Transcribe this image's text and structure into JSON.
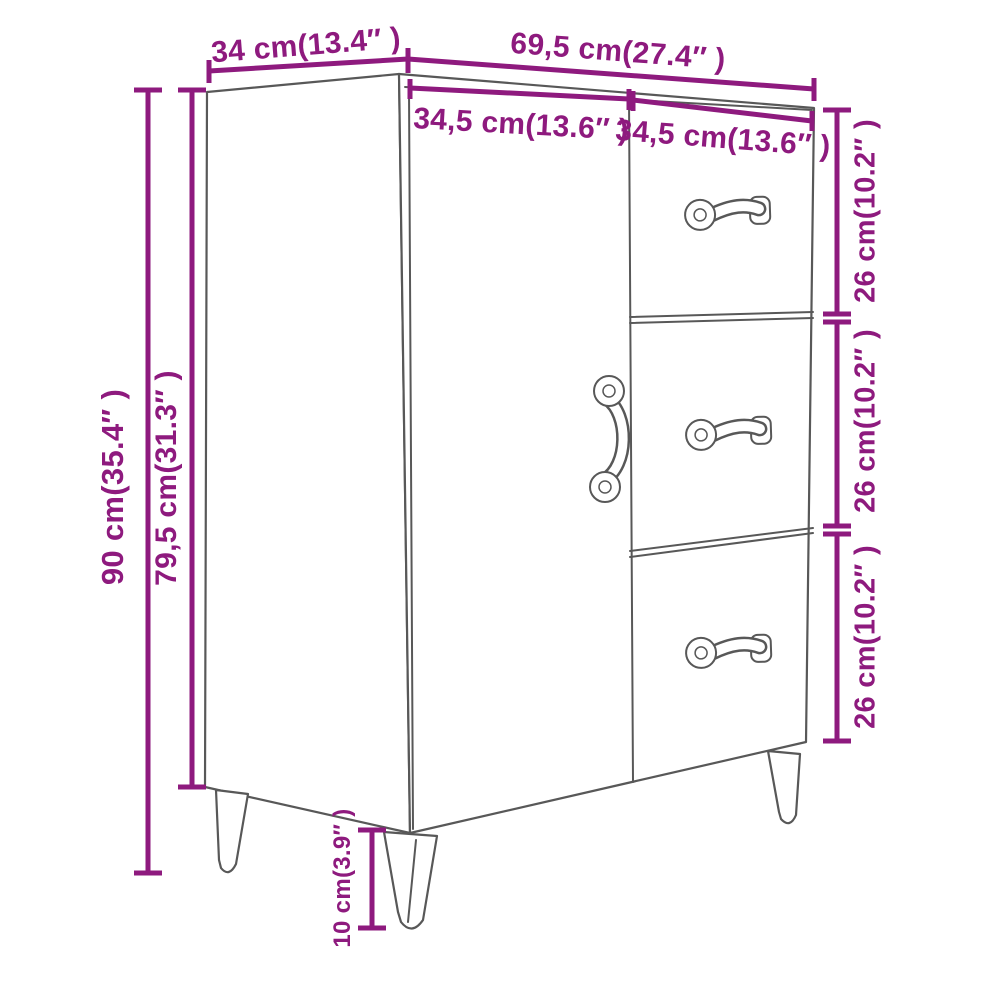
{
  "colors": {
    "dimension": "#8E1A7E",
    "outline": "#585858",
    "background": "#FFFFFF"
  },
  "dimensions": {
    "depth_top": "34 cm(13.4″ )",
    "width_total_top": "69,5 cm(27.4″ )",
    "width_door": "34,5 cm(13.6″ )",
    "width_drawers": "34,5 cm(13.6″ )",
    "height_total": "90 cm(35.4″ )",
    "height_body": "79,5 cm(31.3″ )",
    "height_drawer_top": "26 cm(10.2″ )",
    "height_drawer_middle": "26 cm(10.2″ )",
    "height_drawer_bottom": "26 cm(10.2″ )",
    "height_legs": "10 cm(3.9″ )"
  }
}
